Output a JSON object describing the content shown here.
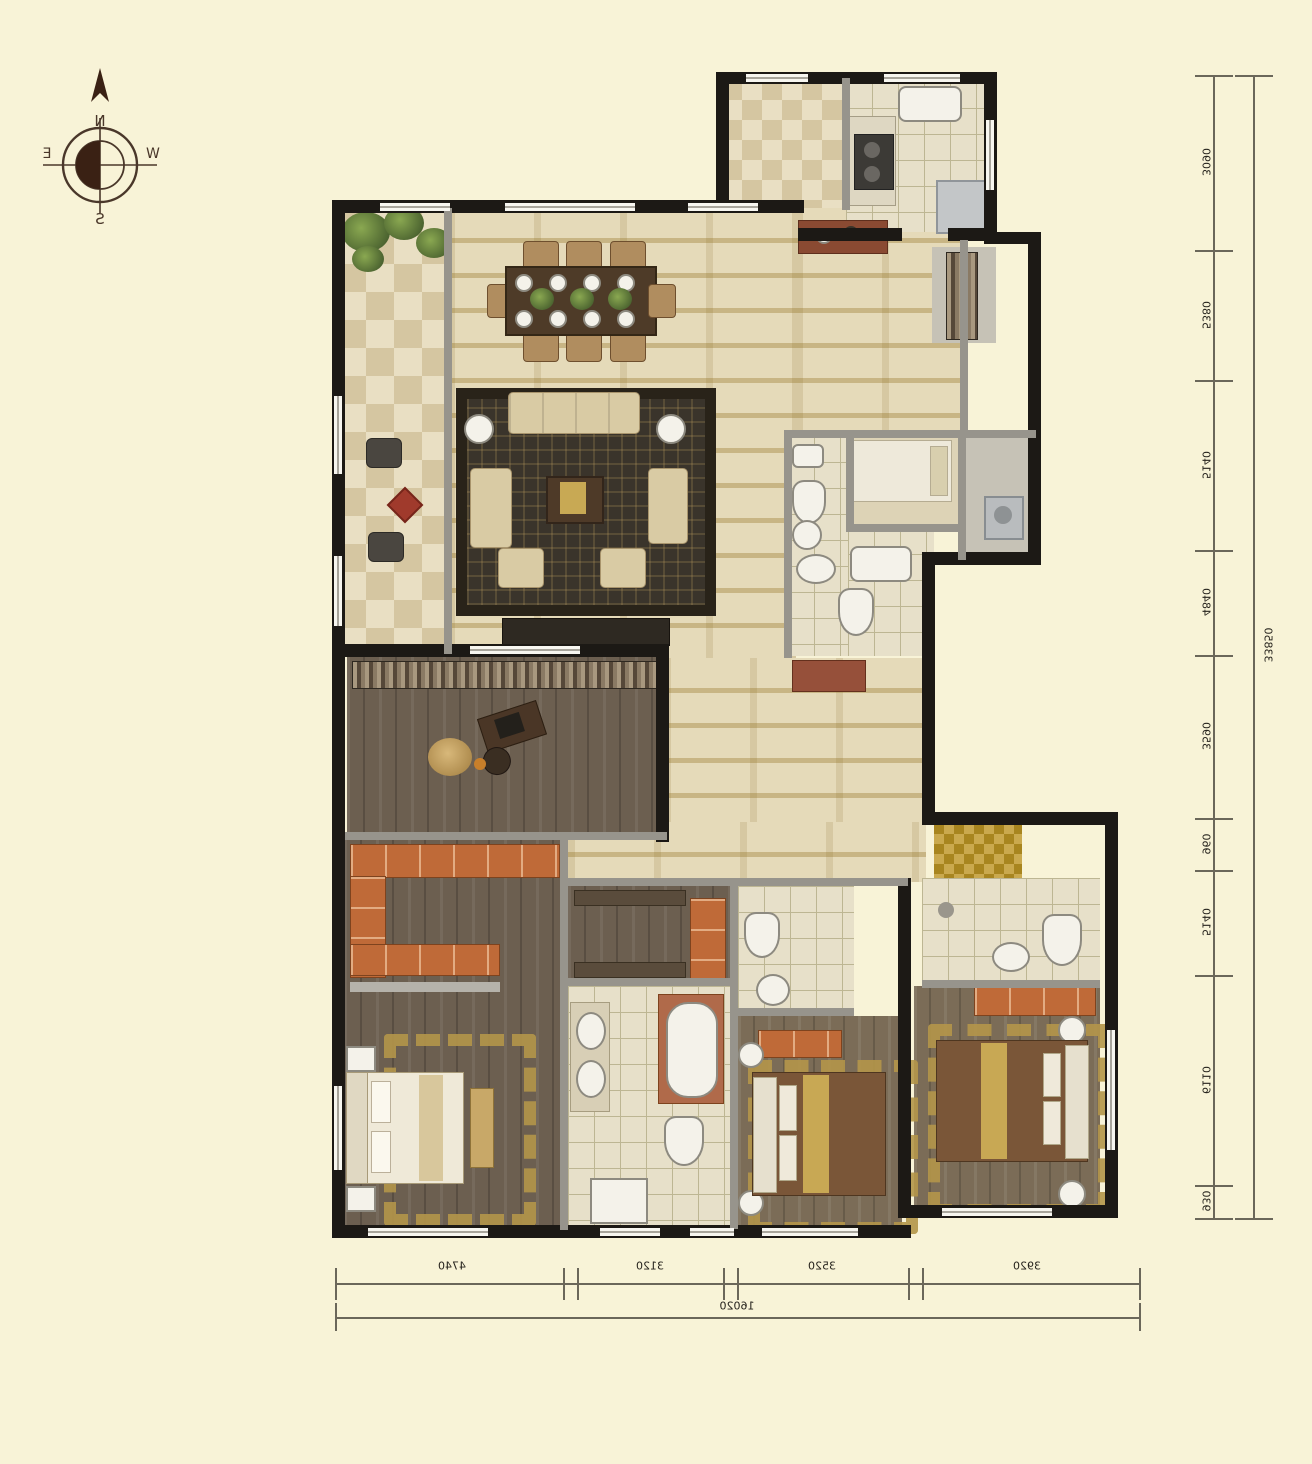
{
  "compass": {
    "north": "N",
    "south": "S",
    "east": "E",
    "west": "W"
  },
  "dimensions": {
    "right": {
      "segments": [
        "3090",
        "5380",
        "5140",
        "4840",
        "3590",
        "960",
        "5140",
        "6110",
        "930"
      ],
      "total": "33850"
    },
    "bottom": {
      "segments": [
        "4740",
        "3120",
        "3520",
        "3920"
      ],
      "total": "16020"
    }
  },
  "colors": {
    "background": "#f8f3d7",
    "wall": "#1c1915",
    "interior_wall": "#97948c",
    "tile_floor": "#e5dab9",
    "wood_floor": "#6c5f50",
    "wardrobe_accent": "#bf6a38",
    "rug_accent": "#b4964a",
    "dimension_line": "#6b675a"
  }
}
